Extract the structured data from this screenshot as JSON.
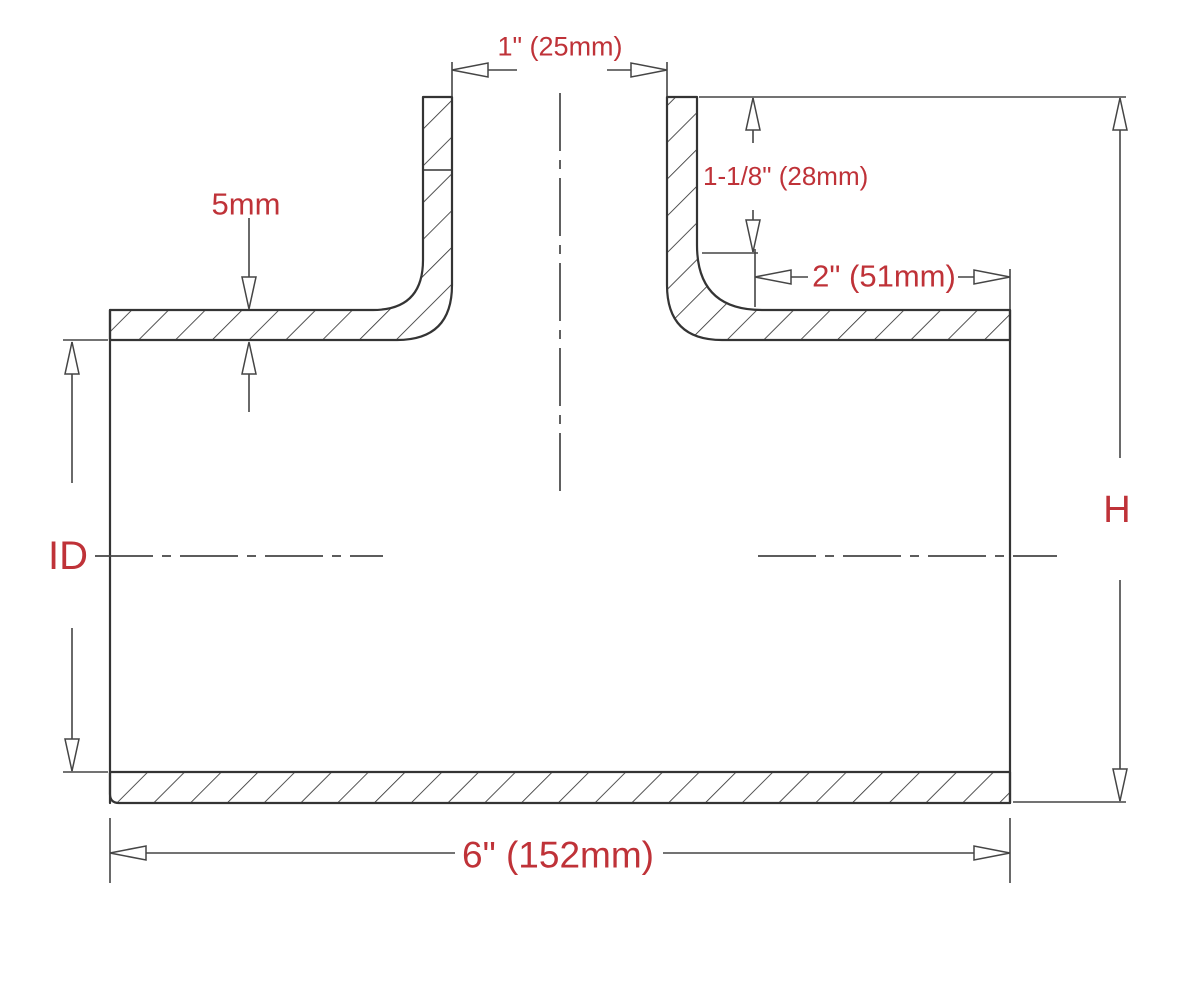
{
  "drawing": {
    "type": "technical-cross-section",
    "subject": "T-shape hose coupler",
    "dimensions": {
      "branch_inner_diameter": "1\" (25mm)",
      "branch_depth": "1-1/8\" (28mm)",
      "wall_thickness": "5mm",
      "right_leg_length": "2\" (51mm)",
      "tube_inner_diameter": "ID",
      "overall_height": "H",
      "overall_length": "6\" (152mm)"
    },
    "colors": {
      "dimension_text": "#bf3238",
      "line": "#343434",
      "dim_line": "#454545",
      "background": "#ffffff"
    }
  }
}
